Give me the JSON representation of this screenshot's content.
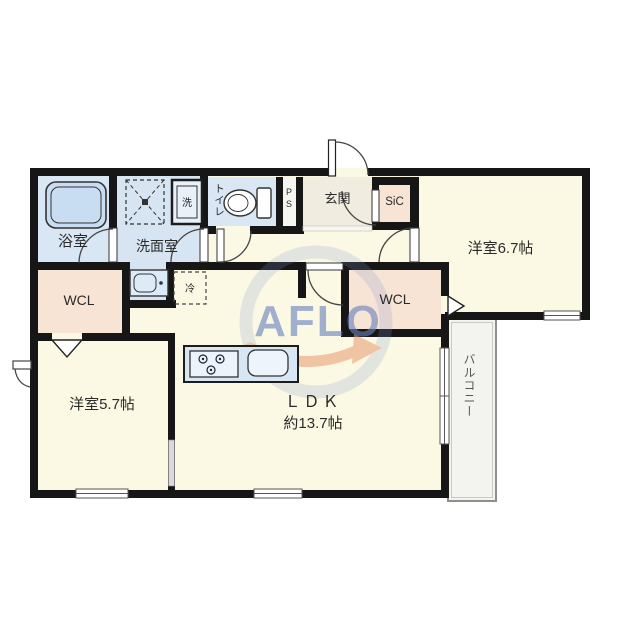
{
  "rooms": {
    "bath": "浴室",
    "washroom": "洗面室",
    "toilet": "トイレ",
    "pipe_space": "PS",
    "entrance": "玄関",
    "shoe_closet": "SiC",
    "bedroom_east": "洋室6.7帖",
    "wcl_left": "WCL",
    "wcl_right": "WCL",
    "bedroom_west": "洋室5.7帖",
    "ldk_name": "ＬＤＫ",
    "ldk_size": "約13.7帖",
    "balcony": "バルコニー"
  },
  "fixtures": {
    "washing_machine": "洗",
    "refrigerator": "冷"
  },
  "watermark": "AFLO",
  "icons": {
    "bathtub": "bathtub-icon",
    "washing_machine": "washing-machine-icon",
    "hatch_box": "hatch-box-icon",
    "toilet": "toilet-icon",
    "vanity": "vanity-sink-icon",
    "refrigerator": "refrigerator-space-icon",
    "kitchen_counter": "kitchen-counter-icon",
    "stove": "stove-burners-icon",
    "kitchen_sink": "kitchen-sink-icon"
  },
  "colors": {
    "wall": "#161616",
    "floor": "#fbf9e4",
    "wet_area": "#d9e7f4",
    "closet": "#f8e4d4",
    "entrance_floor": "#f0ecdf",
    "balcony": "#f3f3f0",
    "watermark_blue": "#6881bd",
    "watermark_orange": "#e89a6e"
  }
}
